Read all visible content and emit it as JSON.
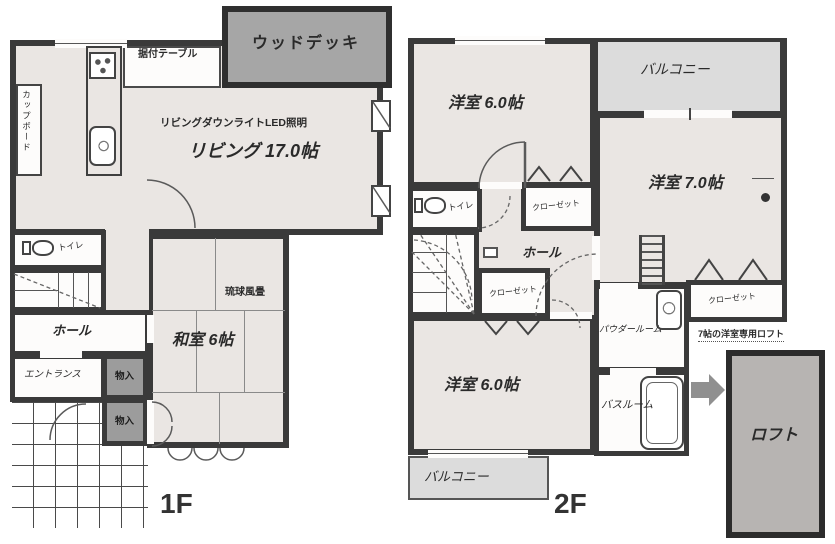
{
  "colors": {
    "wall": "#3a3a3a",
    "room_fill": "#eae6e3",
    "deck_fill": "#a6a6a6",
    "balcony_fill": "#dcdcdc",
    "loft_fill": "#b7b4b2",
    "storage_fill": "#9c9c9c",
    "arrow_fill": "#909090"
  },
  "floor1": {
    "label": "1F",
    "wood_deck": "ウッドデッキ",
    "built_in_table": "据付テーブル",
    "cupboard": "カップボード",
    "led_note": "リビングダウンライトLED照明",
    "living": "リビング 17.0帖",
    "toilet": "トイレ",
    "hall": "ホール",
    "entrance": "エントランス",
    "storage_upper": "物入",
    "storage_lower": "物入",
    "tatami_note": "琉球風畳",
    "japanese_room": "和室 6帖"
  },
  "floor2": {
    "label": "2F",
    "room_nw": "洋室 6.0帖",
    "balcony_top": "バルコニー",
    "room_e": "洋室 7.0帖",
    "toilet": "トイレ",
    "closet_mid": "クローゼット",
    "hall": "ホール",
    "closet_sw": "クローゼット",
    "room_sw": "洋室 6.0帖",
    "powder_room": "パウダールーム",
    "bath_room": "バスルーム",
    "closet_e": "クローゼット",
    "loft": "ロフト",
    "loft_note": "7帖の洋室専用ロフト",
    "balcony_bottom": "バルコニー"
  }
}
